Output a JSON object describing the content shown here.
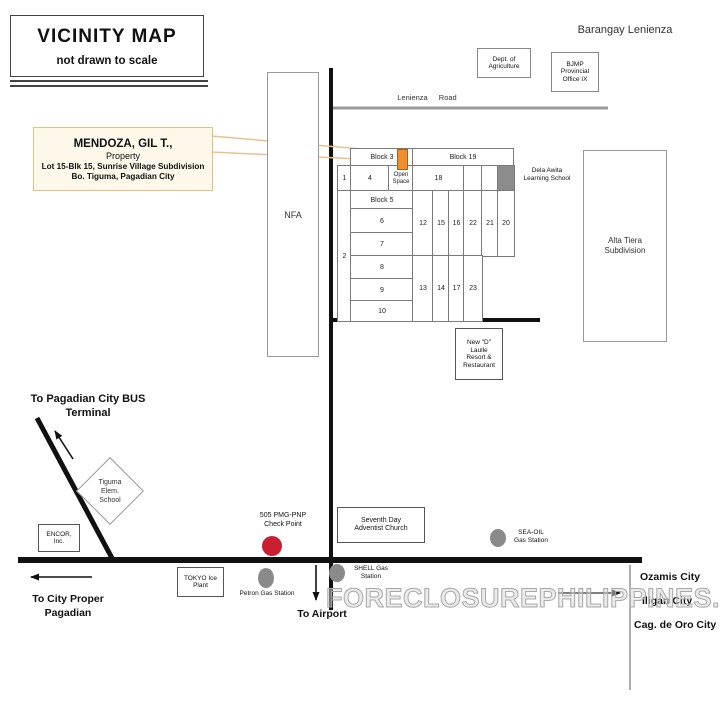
{
  "header": {
    "title": "VICINITY MAP",
    "subtitle": "not drawn to scale",
    "barangay": "Barangay Lenienza",
    "watermark": "FORECLOSUREPHILIPPINES.COM"
  },
  "callout": {
    "owner": "MENDOZA, GIL T.,",
    "kind": "Property",
    "address1": "Lot 15-Blk 15, Sunrise Village Subdivision",
    "address2": "Bo. Tiguma, Pagadian City"
  },
  "roads": {
    "lenienza": "Lenienza Road"
  },
  "directions": {
    "bus_terminal": [
      "To Pagadian City BUS",
      "Terminal"
    ],
    "city_proper": [
      "To City Proper",
      "Pagadian"
    ],
    "airport": "To Airport",
    "cities": [
      "Ozamis City",
      "Iligan City",
      "Cag. de Oro City"
    ]
  },
  "landmarks": {
    "dept_agriculture": [
      "Dept. of",
      "Agriculture"
    ],
    "bjmp": [
      "BJMP",
      "Provincial",
      "Office IX"
    ],
    "nfa": "NFA",
    "alta_tiera": [
      "Alta Tiera",
      "Subdivision"
    ],
    "dela_awita": [
      "Dela Awita",
      "Learning School"
    ],
    "new_d": [
      "New \"D\"",
      "Laulle",
      "Resort &",
      "Restaurant"
    ],
    "adventist": [
      "Seventh Day",
      "Adventist Church"
    ],
    "checkpoint": [
      "505 PMG-PNP",
      "Check Point"
    ],
    "tokyo": [
      "TOKYO Ice",
      "Plant"
    ],
    "encor": [
      "ENCOR,",
      "Inc."
    ],
    "tiguma_school": [
      "Tiguma",
      "Elem.",
      "School"
    ],
    "petron": "Petron Gas Station",
    "shell": [
      "SHELL Gas",
      "Station"
    ],
    "seaoil": [
      "SEA-OIL",
      "Gas Station"
    ]
  },
  "subdivision": {
    "block3": "Block 3",
    "block19": "Block 19",
    "block5": "Block 5",
    "open_space": [
      "Open",
      "Space"
    ],
    "lots": {
      "l1": "1",
      "l2": "2",
      "l4": "4",
      "l6": "6",
      "l7": "7",
      "l8": "8",
      "l9": "9",
      "l10": "10",
      "l12": "12",
      "l13": "13",
      "l14": "14",
      "l15": "15",
      "l16": "16",
      "l17": "17",
      "l18": "18",
      "l20": "20",
      "l21": "21",
      "l22": "22",
      "l23": "23"
    }
  },
  "colors": {
    "property_highlight": "#ef8e31",
    "callout_bg": "#fdf8ea",
    "callout_border": "#e2c183",
    "checkpoint_red": "#c9202f",
    "station_gray": "#8a8a8a",
    "school_cell_gray": "#8c8c8c",
    "road_black": "#111111",
    "road_gray": "#9a9a9a"
  }
}
